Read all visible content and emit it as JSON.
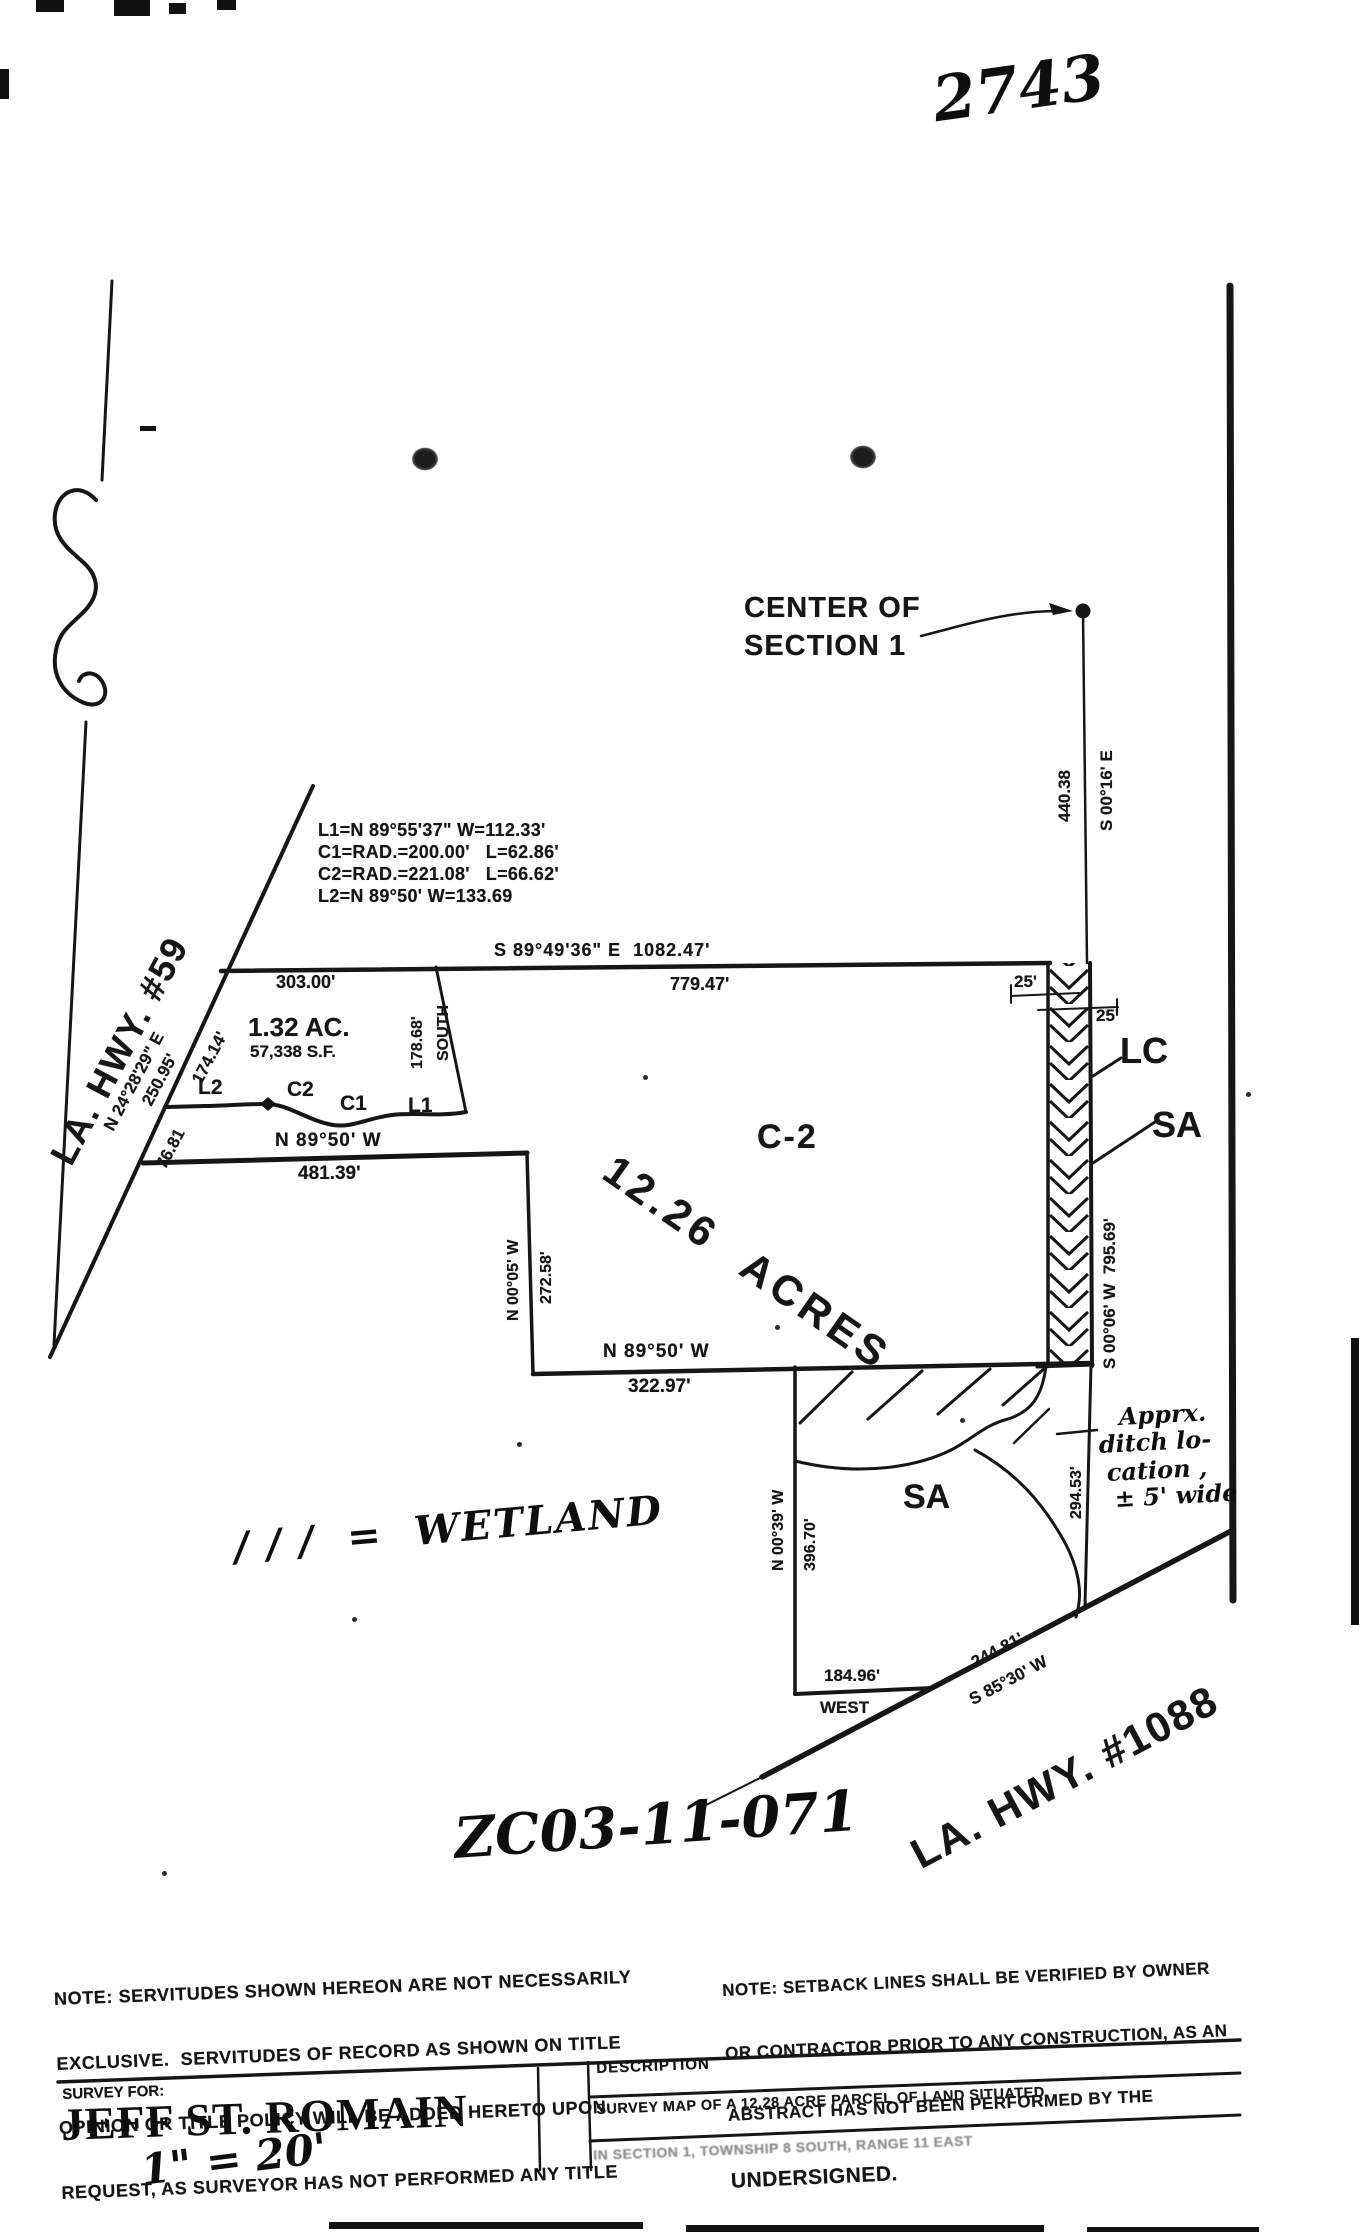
{
  "document": {
    "sheet_number": "2743",
    "case_number": "ZC03-11-071",
    "scale": "1\" = 20'",
    "wetland_legend": "/ / /  =  WETLAND"
  },
  "map": {
    "center_marker": {
      "line1": "CENTER OF",
      "line2": "SECTION 1"
    },
    "section_line": {
      "distance": "440.38",
      "bearing": "S 00°16' E"
    },
    "curve_table": [
      "L1=N 89°55'37\" W=112.33'",
      "C1=RAD.=200.00'   L=62.86'",
      "C2=RAD.=221.08'   L=66.62'",
      "L2=N 89°50' W=133.69"
    ],
    "north_boundary": {
      "bearing": "S 89°49'36\" E  1082.47'",
      "left_distance": "303.00'",
      "right_distance": "779.47'"
    },
    "parcel_132": {
      "area_ac": "1.32 AC.",
      "area_sf": "57,338 S.F.",
      "east_distance": "178.68'",
      "east_bearing": "SOUTH"
    },
    "curve_labels": {
      "l2": "L2",
      "c2": "C2",
      "c1": "C1",
      "l1": "L1"
    },
    "south_line_481": {
      "bearing": "N 89°50' W",
      "distance": "481.39'"
    },
    "hwy59": {
      "name": "LA. HWY. #59",
      "bearing": "N 24°28'29\" E",
      "d250": "250.95'",
      "d174": "174.14'",
      "d76": "76.81"
    },
    "parcel_main": {
      "zoning": "C-2",
      "area": "12.26 ACRES"
    },
    "west_line_272": {
      "bearing": "N 00°05' W",
      "distance": "272.58'"
    },
    "south_line_322": {
      "bearing": "N 89°50' W",
      "distance": "322.97'"
    },
    "strip": {
      "width_left": "25'",
      "width_right": "25'",
      "label_lc": "LC",
      "label_sa": "SA",
      "bearing": "S 00°06' W  795.69'"
    },
    "east_line_294": {
      "distance": "294.53'"
    },
    "ditch_note": {
      "l1": "Apprx.",
      "l2": "ditch lo-",
      "l3": "cation ,",
      "l4": "± 5' wide"
    },
    "sa_area": "SA",
    "west_line_396": {
      "bearing": "N 00°39' W",
      "distance": "396.70'"
    },
    "south_boundary": {
      "bearing": "WEST",
      "distance": "184.96'"
    },
    "hwy1088": {
      "name": "LA. HWY. #1088",
      "bearing": "S 85°30' W",
      "distance": "244.81'"
    }
  },
  "notes": {
    "servitudes": [
      "NOTE: SERVITUDES SHOWN HEREON ARE NOT NECESSARILY",
      "EXCLUSIVE.  SERVITUDES OF RECORD AS SHOWN ON TITLE",
      "OPINION OR TITLE POLICY WILL BE ADDED HERETO UPON",
      "REQUEST, AS SURVEYOR HAS NOT PERFORMED ANY TITLE",
      "SEARCH OR ABSTRACT."
    ],
    "setback": [
      "NOTE: SETBACK LINES SHALL BE VERIFIED BY OWNER",
      "OR CONTRACTOR PRIOR TO ANY CONSTRUCTION, AS AN",
      "ABSTRACT HAS NOT BEEN PERFORMED BY THE",
      "UNDERSIGNED."
    ]
  },
  "title_block": {
    "survey_for_label": "SURVEY FOR:",
    "client": "JEFF ST. ROMAIN",
    "description_label": "DESCRIPTION",
    "description_line1": "SURVEY MAP OF A 12.28 ACRE PARCEL OF LAND SITUATED",
    "description_line2": "IN SECTION 1, TOWNSHIP 8 SOUTH, RANGE 11 EAST"
  }
}
